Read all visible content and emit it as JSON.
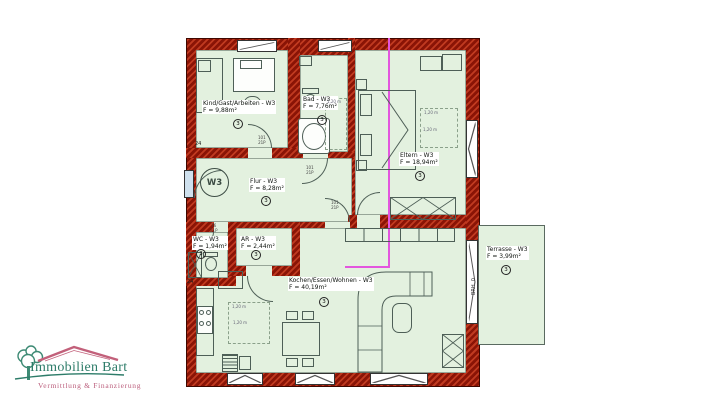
{
  "logo": {
    "name": "Immobilien Bart",
    "tagline": "Vermittlung & Finanzierung",
    "name_color": "#2d7c69",
    "tagline_color": "#bb5e7c",
    "roof_color": "#c2607a",
    "tree_color": "#3d8a74"
  },
  "plan": {
    "unit_badge": "W3",
    "colors": {
      "wall": "#8a1406",
      "wall_hatch": "#c03a20",
      "floor": "#e3f1df",
      "section_line": "#e356de",
      "furniture_stroke": "#4e5f57",
      "window_glass": "#cfe1ee"
    },
    "rooms": [
      {
        "id": "kind",
        "name": "Kind/Gast/Arbeiten - W3",
        "area": "F = 9,88m²",
        "number": "3"
      },
      {
        "id": "bad",
        "name": "Bad - W3",
        "area": "F = 7,76m²",
        "number": "3"
      },
      {
        "id": "eltern",
        "name": "Eltern - W3",
        "area": "F = 18,94m²",
        "number": "3"
      },
      {
        "id": "flur",
        "name": "Flur - W3",
        "area": "F = 8,28m²",
        "number": "3"
      },
      {
        "id": "wc",
        "name": "WC - W3",
        "area": "F = 1,94m²",
        "number": "3"
      },
      {
        "id": "ar",
        "name": "AR - W3",
        "area": "F = 2,44m²",
        "number": "3"
      },
      {
        "id": "wohnen",
        "name": "Kochen/Essen/Wohnen - W3",
        "area": "F = 40,19m²",
        "number": "3"
      },
      {
        "id": "terrasse",
        "name": "Terrasse - W3",
        "area": "F = 3,99m²",
        "number": "3"
      }
    ],
    "annotations": {
      "brh": "BRH..0",
      "dim_a": "24",
      "dim_b": "24",
      "grid": "1,20 m",
      "door_tag": "101\n21P",
      "door_tag_wc": "76\n21P"
    }
  }
}
